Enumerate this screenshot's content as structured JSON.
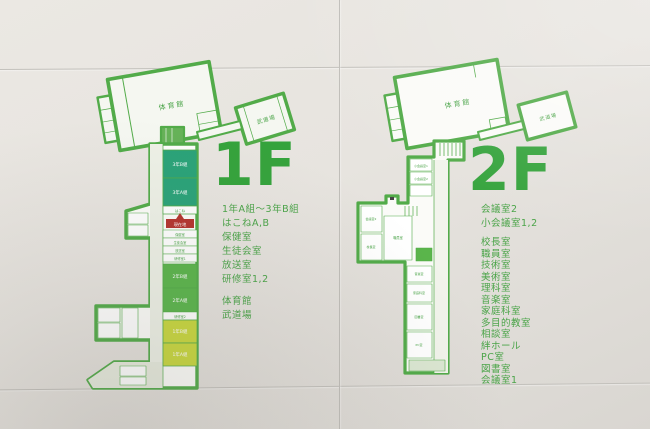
{
  "colors": {
    "wall": "#e7e4df",
    "seam": "#c3c1bc",
    "outline_green": "#52ab49",
    "heading_green": "#35a33c",
    "legend_green": "#4aa448",
    "classroom_teal": "#2aa379",
    "classroom_green": "#5ab54b",
    "classroom_yellow": "#c9d83e",
    "corridor_light": "#e8ecdf",
    "marker_red": "#b5342e"
  },
  "floor1": {
    "heading": "1F",
    "legend_classrooms": [
      "1年A組〜3年B組",
      "はこねA,B",
      "保健室",
      "生徒会室",
      "放送室",
      "研修室1,2"
    ],
    "legend_facilities": [
      "体育館",
      "武道場"
    ],
    "map": {
      "gym": "体育館",
      "dojo": "武道場",
      "marker": "現在地",
      "classrooms_3rd": [
        "3年B組",
        "3年A組"
      ],
      "classrooms_2nd": [
        "2年B組",
        "2年A組"
      ],
      "classrooms_1st": [
        "1年B組",
        "1年A組"
      ],
      "small_rooms": [
        "はこね",
        "保健室",
        "生徒会室",
        "放送室",
        "研修室1",
        "研修室2"
      ]
    }
  },
  "floor2": {
    "heading": "2F",
    "legend_meeting": [
      "会議室2",
      "小会議室1,2"
    ],
    "legend_rooms": [
      "校長室",
      "職員室",
      "技術室",
      "美術室",
      "理科室",
      "音楽室",
      "家庭科室",
      "多目的教室",
      "相談室",
      "絆ホール",
      "PC室",
      "図書室",
      "会議室1"
    ],
    "map": {
      "gym": "体育館",
      "dojo": "武道場",
      "rooms": [
        "会議室2",
        "小会議室1",
        "小会議室2",
        "校長室",
        "職員室",
        "音楽室",
        "家庭科室",
        "図書室",
        "PC室"
      ]
    }
  }
}
